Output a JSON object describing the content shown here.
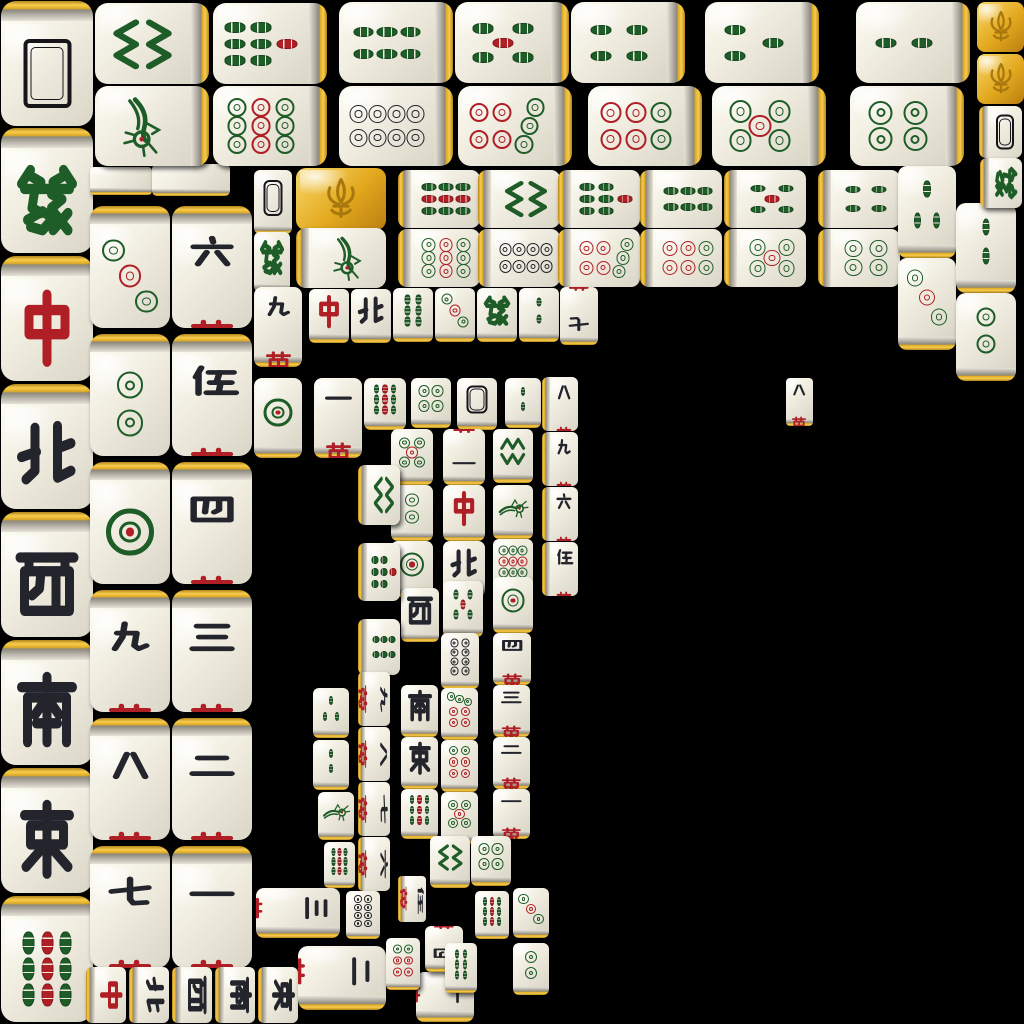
{
  "app": "mahjong-solitaire-tile-board",
  "canvas": {
    "width": 1024,
    "height": 1024
  },
  "colors": {
    "background": "#000000",
    "tile_face": "#efecdf",
    "gold_edge": "#e8b62a",
    "suit_green": "#1e5c28",
    "suit_red": "#b01f26",
    "suit_black": "#23242c"
  },
  "faces": {
    "back": {
      "name": "tile-back",
      "label": ""
    },
    "blank": {
      "name": "tile-edge",
      "label": ""
    },
    "gold": {
      "name": "flower-gold",
      "label": "fleur-de-lis"
    },
    "zh": {
      "name": "green-dragon",
      "label": "發"
    },
    "zb": {
      "name": "red-dragon",
      "label": "中"
    },
    "wN": {
      "name": "north-wind",
      "label": "北"
    },
    "wS": {
      "name": "south-wind",
      "label": "南"
    },
    "wE": {
      "name": "east-wind",
      "label": "東"
    },
    "wW": {
      "name": "west-wind",
      "label": "西"
    },
    "m1": {
      "name": "character-1",
      "label": "一萬"
    },
    "m2": {
      "name": "character-2",
      "label": "二萬"
    },
    "m3": {
      "name": "character-3",
      "label": "三萬"
    },
    "m4": {
      "name": "character-4",
      "label": "四萬"
    },
    "m5": {
      "name": "character-5",
      "label": "伍萬"
    },
    "m6": {
      "name": "character-6",
      "label": "六萬"
    },
    "m7": {
      "name": "character-7",
      "label": "七萬"
    },
    "m8": {
      "name": "character-8",
      "label": "八萬"
    },
    "m9": {
      "name": "character-9",
      "label": "九萬"
    },
    "d1": {
      "name": "circle-1",
      "label": ""
    },
    "d2": {
      "name": "circle-2",
      "label": ""
    },
    "d3": {
      "name": "circle-3",
      "label": ""
    },
    "d4": {
      "name": "circle-4",
      "label": ""
    },
    "d5": {
      "name": "circle-5",
      "label": ""
    },
    "d6": {
      "name": "circle-6",
      "label": ""
    },
    "d7": {
      "name": "circle-7",
      "label": ""
    },
    "d8": {
      "name": "circle-8",
      "label": ""
    },
    "d9": {
      "name": "circle-9",
      "label": ""
    },
    "b1": {
      "name": "bamboo-1",
      "label": ""
    },
    "b2": {
      "name": "bamboo-2",
      "label": ""
    },
    "b3": {
      "name": "bamboo-3",
      "label": ""
    },
    "b4": {
      "name": "bamboo-4",
      "label": ""
    },
    "b5": {
      "name": "bamboo-5",
      "label": ""
    },
    "b6": {
      "name": "bamboo-6",
      "label": ""
    },
    "b7": {
      "name": "bamboo-7",
      "label": ""
    },
    "b8": {
      "name": "bamboo-8",
      "label": ""
    },
    "b9": {
      "name": "bamboo-9",
      "label": ""
    }
  },
  "tiles": [
    {
      "f": "back",
      "x": 1,
      "y": 1,
      "w": 92,
      "h": 125,
      "g": "t"
    },
    {
      "f": "zh",
      "x": 1,
      "y": 128,
      "w": 92,
      "h": 125,
      "g": "t"
    },
    {
      "f": "zb",
      "x": 1,
      "y": 256,
      "w": 92,
      "h": 125,
      "g": "t"
    },
    {
      "f": "wN",
      "x": 1,
      "y": 384,
      "w": 92,
      "h": 125,
      "g": "t"
    },
    {
      "f": "wW",
      "x": 1,
      "y": 512,
      "w": 92,
      "h": 125,
      "g": "t"
    },
    {
      "f": "wS",
      "x": 1,
      "y": 640,
      "w": 92,
      "h": 125,
      "g": "t"
    },
    {
      "f": "wE",
      "x": 1,
      "y": 768,
      "w": 92,
      "h": 125,
      "g": "t"
    },
    {
      "f": "b9",
      "x": 1,
      "y": 896,
      "w": 92,
      "h": 126,
      "g": "t"
    },
    {
      "f": "blank",
      "x": 90,
      "y": 167,
      "w": 62,
      "h": 28,
      "g": "b"
    },
    {
      "f": "blank",
      "x": 152,
      "y": 164,
      "w": 78,
      "h": 32,
      "g": "b"
    },
    {
      "f": "d3",
      "x": 90,
      "y": 206,
      "w": 80,
      "h": 122,
      "g": "t"
    },
    {
      "f": "d2",
      "x": 90,
      "y": 334,
      "w": 80,
      "h": 122,
      "g": "t"
    },
    {
      "f": "d1",
      "x": 90,
      "y": 462,
      "w": 80,
      "h": 122,
      "g": "t"
    },
    {
      "f": "m9",
      "x": 90,
      "y": 590,
      "w": 80,
      "h": 122,
      "g": "t"
    },
    {
      "f": "m8",
      "x": 90,
      "y": 718,
      "w": 80,
      "h": 122,
      "g": "t"
    },
    {
      "f": "m7",
      "x": 90,
      "y": 846,
      "w": 80,
      "h": 122,
      "g": "t"
    },
    {
      "f": "m6",
      "x": 172,
      "y": 206,
      "w": 80,
      "h": 122,
      "g": "t"
    },
    {
      "f": "m5",
      "x": 172,
      "y": 334,
      "w": 80,
      "h": 122,
      "g": "t"
    },
    {
      "f": "m4",
      "x": 172,
      "y": 462,
      "w": 80,
      "h": 122,
      "g": "t"
    },
    {
      "f": "m3",
      "x": 172,
      "y": 590,
      "w": 80,
      "h": 122,
      "g": "t"
    },
    {
      "f": "m2",
      "x": 172,
      "y": 718,
      "w": 80,
      "h": 122,
      "g": "t"
    },
    {
      "f": "m1",
      "x": 172,
      "y": 846,
      "w": 80,
      "h": 122,
      "g": "t"
    },
    {
      "f": "b8",
      "x": 95,
      "y": 3,
      "w": 114,
      "h": 81,
      "r": 90,
      "g": "r"
    },
    {
      "f": "b7",
      "x": 213,
      "y": 3,
      "w": 114,
      "h": 81,
      "r": 90,
      "g": "r"
    },
    {
      "f": "b6",
      "x": 339,
      "y": 2,
      "w": 114,
      "h": 81,
      "r": 90,
      "g": "r"
    },
    {
      "f": "b5",
      "x": 455,
      "y": 2,
      "w": 114,
      "h": 81,
      "r": 90,
      "g": "r"
    },
    {
      "f": "b4",
      "x": 571,
      "y": 2,
      "w": 114,
      "h": 81,
      "r": 90,
      "g": "r"
    },
    {
      "f": "b3",
      "x": 705,
      "y": 2,
      "w": 114,
      "h": 81,
      "r": 90,
      "g": "r"
    },
    {
      "f": "b2",
      "x": 856,
      "y": 2,
      "w": 114,
      "h": 81,
      "r": 90,
      "g": "r"
    },
    {
      "f": "b1",
      "x": 95,
      "y": 86,
      "w": 114,
      "h": 80,
      "r": 90,
      "g": "r"
    },
    {
      "f": "d9",
      "x": 213,
      "y": 86,
      "w": 114,
      "h": 80,
      "r": 90,
      "g": "r"
    },
    {
      "f": "d8",
      "x": 339,
      "y": 86,
      "w": 114,
      "h": 80,
      "r": 90,
      "g": "r"
    },
    {
      "f": "d7",
      "x": 458,
      "y": 86,
      "w": 114,
      "h": 80,
      "r": 90,
      "g": "r"
    },
    {
      "f": "d6",
      "x": 588,
      "y": 86,
      "w": 114,
      "h": 80,
      "r": 90,
      "g": "r"
    },
    {
      "f": "d5",
      "x": 712,
      "y": 86,
      "w": 114,
      "h": 80,
      "r": 90,
      "g": "r"
    },
    {
      "f": "d4",
      "x": 850,
      "y": 86,
      "w": 114,
      "h": 80,
      "r": 90,
      "g": "r"
    },
    {
      "f": "back",
      "x": 254,
      "y": 170,
      "w": 38,
      "h": 64,
      "g": "b"
    },
    {
      "f": "gold",
      "x": 296,
      "y": 168,
      "w": 90,
      "h": 62,
      "g": "a"
    },
    {
      "f": "b9",
      "x": 398,
      "y": 170,
      "w": 82,
      "h": 58,
      "r": 90,
      "g": "l"
    },
    {
      "f": "b8",
      "x": 478,
      "y": 170,
      "w": 82,
      "h": 58,
      "r": 90,
      "g": "l"
    },
    {
      "f": "b7",
      "x": 558,
      "y": 170,
      "w": 82,
      "h": 58,
      "r": 90,
      "g": "l"
    },
    {
      "f": "b6",
      "x": 640,
      "y": 170,
      "w": 82,
      "h": 58,
      "r": 90,
      "g": "l"
    },
    {
      "f": "b5",
      "x": 724,
      "y": 170,
      "w": 82,
      "h": 58,
      "r": 90,
      "g": "l"
    },
    {
      "f": "b4",
      "x": 818,
      "y": 170,
      "w": 82,
      "h": 58,
      "r": 90,
      "g": "l"
    },
    {
      "f": "zh",
      "x": 254,
      "y": 232,
      "w": 36,
      "h": 60,
      "g": "b"
    },
    {
      "f": "b1",
      "x": 296,
      "y": 228,
      "w": 90,
      "h": 60,
      "r": 90,
      "g": "l"
    },
    {
      "f": "d9",
      "x": 398,
      "y": 229,
      "w": 82,
      "h": 58,
      "r": 90,
      "g": "l"
    },
    {
      "f": "d8",
      "x": 478,
      "y": 229,
      "w": 82,
      "h": 58,
      "r": 90,
      "g": "l"
    },
    {
      "f": "d7",
      "x": 558,
      "y": 229,
      "w": 82,
      "h": 58,
      "r": 90,
      "g": "l"
    },
    {
      "f": "d6",
      "x": 640,
      "y": 229,
      "w": 82,
      "h": 58,
      "r": 90,
      "g": "l"
    },
    {
      "f": "d5",
      "x": 724,
      "y": 229,
      "w": 82,
      "h": 58,
      "r": 90,
      "g": "l"
    },
    {
      "f": "d4",
      "x": 818,
      "y": 229,
      "w": 82,
      "h": 58,
      "r": 90,
      "g": "l"
    },
    {
      "f": "b3",
      "x": 898,
      "y": 166,
      "w": 58,
      "h": 92,
      "g": "b"
    },
    {
      "f": "d3",
      "x": 898,
      "y": 258,
      "w": 58,
      "h": 92,
      "g": "b"
    },
    {
      "f": "b2",
      "x": 956,
      "y": 203,
      "w": 60,
      "h": 90,
      "g": "b"
    },
    {
      "f": "d2",
      "x": 956,
      "y": 293,
      "w": 60,
      "h": 88,
      "g": "b"
    },
    {
      "f": "gold",
      "x": 977,
      "y": 2,
      "w": 47,
      "h": 50,
      "g": "a"
    },
    {
      "f": "gold",
      "x": 977,
      "y": 54,
      "w": 47,
      "h": 50,
      "g": "a"
    },
    {
      "f": "back",
      "x": 979,
      "y": 106,
      "w": 43,
      "h": 52,
      "g": "l"
    },
    {
      "f": "zh",
      "x": 980,
      "y": 158,
      "w": 42,
      "h": 50,
      "r": 90,
      "g": "l"
    },
    {
      "f": "m9",
      "x": 254,
      "y": 287,
      "w": 48,
      "h": 80,
      "g": "b"
    },
    {
      "f": "zb",
      "x": 309,
      "y": 289,
      "w": 40,
      "h": 54,
      "g": "b"
    },
    {
      "f": "wN",
      "x": 351,
      "y": 289,
      "w": 40,
      "h": 54,
      "g": "b"
    },
    {
      "f": "b6",
      "x": 393,
      "y": 288,
      "w": 40,
      "h": 54,
      "g": "b"
    },
    {
      "f": "d3",
      "x": 435,
      "y": 288,
      "w": 40,
      "h": 54,
      "g": "b"
    },
    {
      "f": "zh",
      "x": 477,
      "y": 288,
      "w": 40,
      "h": 54,
      "g": "b"
    },
    {
      "f": "b2",
      "x": 519,
      "y": 288,
      "w": 40,
      "h": 54,
      "g": "b"
    },
    {
      "f": "m7",
      "x": 560,
      "y": 287,
      "w": 38,
      "h": 58,
      "r": 180,
      "g": "b"
    },
    {
      "f": "m8",
      "x": 786,
      "y": 378,
      "w": 27,
      "h": 48,
      "g": "b"
    },
    {
      "f": "d1",
      "x": 254,
      "y": 378,
      "w": 48,
      "h": 80,
      "g": "b"
    },
    {
      "f": "m1",
      "x": 314,
      "y": 378,
      "w": 48,
      "h": 80,
      "g": "b"
    },
    {
      "f": "b9",
      "x": 364,
      "y": 378,
      "w": 42,
      "h": 52,
      "g": "b"
    },
    {
      "f": "d4",
      "x": 411,
      "y": 378,
      "w": 40,
      "h": 50,
      "g": "b"
    },
    {
      "f": "back",
      "x": 457,
      "y": 378,
      "w": 40,
      "h": 52,
      "g": "b"
    },
    {
      "f": "b2",
      "x": 505,
      "y": 378,
      "w": 36,
      "h": 50,
      "g": "b"
    },
    {
      "f": "m8",
      "x": 542,
      "y": 377,
      "w": 36,
      "h": 54,
      "g": "l"
    },
    {
      "f": "m9",
      "x": 542,
      "y": 432,
      "w": 36,
      "h": 54,
      "g": "l"
    },
    {
      "f": "m6",
      "x": 542,
      "y": 487,
      "w": 36,
      "h": 54,
      "g": "l"
    },
    {
      "f": "m5",
      "x": 542,
      "y": 542,
      "w": 36,
      "h": 54,
      "g": "l"
    },
    {
      "f": "d5",
      "x": 391,
      "y": 429,
      "w": 42,
      "h": 56,
      "g": "b"
    },
    {
      "f": "m1",
      "x": 443,
      "y": 429,
      "w": 42,
      "h": 56,
      "r": 180,
      "g": "b"
    },
    {
      "f": "b8",
      "x": 493,
      "y": 429,
      "w": 40,
      "h": 54,
      "g": "b"
    },
    {
      "f": "d2",
      "x": 391,
      "y": 485,
      "w": 42,
      "h": 56,
      "g": "b"
    },
    {
      "f": "zb",
      "x": 443,
      "y": 485,
      "w": 42,
      "h": 56,
      "g": "b"
    },
    {
      "f": "b1",
      "x": 493,
      "y": 485,
      "w": 40,
      "h": 54,
      "g": "b"
    },
    {
      "f": "d1",
      "x": 391,
      "y": 541,
      "w": 42,
      "h": 56,
      "g": "b"
    },
    {
      "f": "wN",
      "x": 443,
      "y": 541,
      "w": 42,
      "h": 56,
      "g": "b"
    },
    {
      "f": "d9",
      "x": 493,
      "y": 539,
      "w": 40,
      "h": 54,
      "g": "b"
    },
    {
      "f": "wW",
      "x": 401,
      "y": 588,
      "w": 38,
      "h": 54,
      "g": "b"
    },
    {
      "f": "b5",
      "x": 443,
      "y": 581,
      "w": 40,
      "h": 56,
      "g": "b"
    },
    {
      "f": "d1",
      "x": 493,
      "y": 577,
      "w": 40,
      "h": 56,
      "g": "b"
    },
    {
      "f": "wS",
      "x": 401,
      "y": 685,
      "w": 37,
      "h": 52,
      "g": "b"
    },
    {
      "f": "wE",
      "x": 401,
      "y": 737,
      "w": 37,
      "h": 52,
      "g": "b"
    },
    {
      "f": "b9",
      "x": 401,
      "y": 789,
      "w": 37,
      "h": 50,
      "g": "b"
    },
    {
      "f": "d8",
      "x": 441,
      "y": 633,
      "w": 38,
      "h": 56,
      "g": "b"
    },
    {
      "f": "d7",
      "x": 441,
      "y": 688,
      "w": 37,
      "h": 52,
      "g": "b"
    },
    {
      "f": "d6",
      "x": 441,
      "y": 740,
      "w": 37,
      "h": 52,
      "g": "b"
    },
    {
      "f": "d5",
      "x": 441,
      "y": 792,
      "w": 37,
      "h": 52,
      "g": "b"
    },
    {
      "f": "m4",
      "x": 493,
      "y": 633,
      "w": 38,
      "h": 52,
      "g": "b"
    },
    {
      "f": "m3",
      "x": 493,
      "y": 685,
      "w": 37,
      "h": 52,
      "g": "b"
    },
    {
      "f": "m2",
      "x": 493,
      "y": 737,
      "w": 37,
      "h": 52,
      "g": "b"
    },
    {
      "f": "m1",
      "x": 493,
      "y": 789,
      "w": 37,
      "h": 50,
      "g": "b"
    },
    {
      "f": "b3",
      "x": 313,
      "y": 688,
      "w": 36,
      "h": 50,
      "g": "b"
    },
    {
      "f": "b2",
      "x": 313,
      "y": 740,
      "w": 36,
      "h": 50,
      "g": "b"
    },
    {
      "f": "b1",
      "x": 318,
      "y": 792,
      "w": 36,
      "h": 48,
      "g": "b"
    },
    {
      "f": "b9",
      "x": 324,
      "y": 842,
      "w": 31,
      "h": 46,
      "g": "b"
    },
    {
      "f": "b8",
      "x": 358,
      "y": 465,
      "w": 42,
      "h": 60,
      "r": 90,
      "g": "l"
    },
    {
      "f": "b7",
      "x": 358,
      "y": 543,
      "w": 42,
      "h": 58,
      "r": 90,
      "g": "l"
    },
    {
      "f": "b6",
      "x": 358,
      "y": 619,
      "w": 42,
      "h": 56,
      "r": 90,
      "g": "l"
    },
    {
      "f": "m9",
      "x": 358,
      "y": 672,
      "w": 32,
      "h": 54,
      "r": 90,
      "g": "l"
    },
    {
      "f": "m8",
      "x": 358,
      "y": 727,
      "w": 32,
      "h": 54,
      "r": 90,
      "g": "l"
    },
    {
      "f": "m7",
      "x": 358,
      "y": 782,
      "w": 32,
      "h": 54,
      "r": 90,
      "g": "l"
    },
    {
      "f": "m6",
      "x": 358,
      "y": 837,
      "w": 32,
      "h": 54,
      "r": 90,
      "g": "l"
    },
    {
      "f": "zb",
      "x": 86,
      "y": 967,
      "w": 40,
      "h": 56,
      "r": 90,
      "g": "l"
    },
    {
      "f": "wN",
      "x": 129,
      "y": 967,
      "w": 40,
      "h": 56,
      "r": 90,
      "g": "l"
    },
    {
      "f": "wW",
      "x": 172,
      "y": 967,
      "w": 40,
      "h": 56,
      "r": 90,
      "g": "l"
    },
    {
      "f": "wS",
      "x": 215,
      "y": 967,
      "w": 40,
      "h": 56,
      "r": 90,
      "g": "l"
    },
    {
      "f": "wE",
      "x": 258,
      "y": 967,
      "w": 40,
      "h": 56,
      "r": 90,
      "g": "l"
    },
    {
      "f": "m3",
      "x": 256,
      "y": 888,
      "w": 84,
      "h": 50,
      "r": 90,
      "g": "b"
    },
    {
      "f": "m2",
      "x": 298,
      "y": 946,
      "w": 88,
      "h": 64,
      "r": 90,
      "g": "b"
    },
    {
      "f": "m1",
      "x": 416,
      "y": 972,
      "w": 58,
      "h": 50,
      "r": 90,
      "g": "b"
    },
    {
      "f": "m4",
      "x": 425,
      "y": 926,
      "w": 38,
      "h": 46,
      "r": 180,
      "g": "b"
    },
    {
      "f": "m5",
      "x": 398,
      "y": 876,
      "w": 28,
      "h": 46,
      "r": 90,
      "g": "l"
    },
    {
      "f": "d8",
      "x": 346,
      "y": 891,
      "w": 34,
      "h": 48,
      "g": "b"
    },
    {
      "f": "d6",
      "x": 386,
      "y": 938,
      "w": 34,
      "h": 52,
      "g": "b"
    },
    {
      "f": "b8",
      "x": 430,
      "y": 836,
      "w": 40,
      "h": 52,
      "r": 90,
      "g": "b"
    },
    {
      "f": "d4",
      "x": 471,
      "y": 836,
      "w": 40,
      "h": 50,
      "g": "b"
    },
    {
      "f": "b9",
      "x": 475,
      "y": 891,
      "w": 34,
      "h": 48,
      "g": "b"
    },
    {
      "f": "d3",
      "x": 513,
      "y": 888,
      "w": 36,
      "h": 50,
      "g": "b"
    },
    {
      "f": "b6",
      "x": 445,
      "y": 943,
      "w": 32,
      "h": 50,
      "g": "b"
    },
    {
      "f": "d2",
      "x": 513,
      "y": 943,
      "w": 36,
      "h": 52,
      "g": "b"
    }
  ]
}
